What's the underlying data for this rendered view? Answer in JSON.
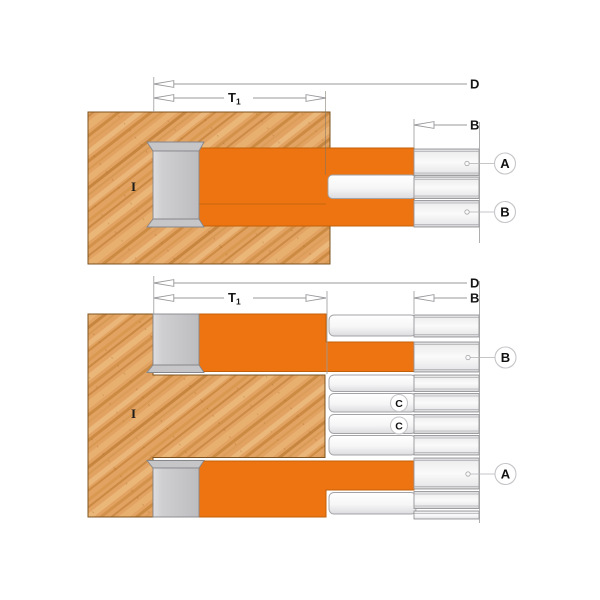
{
  "page": {
    "background": "#ffffff"
  },
  "figure": {
    "type": "technical-diagram",
    "subject": "adjustable-groover-cutter-head-cross-section",
    "colors": {
      "cutter_orange": "#ED7410",
      "cutter_orange_edge": "#C05F08",
      "wood_tan": "#E2A261",
      "wood_grain_dark": "#B9772A",
      "steel_gray": "#C6C6C9",
      "plate_edge_gray": "#96969A",
      "dim_line_gray": "#9A9A9A",
      "label_black": "#151515"
    },
    "labels": {
      "overall_diameter": "D",
      "cutting_depth": "T",
      "cutting_depth_sub": "1",
      "kerf_width": "B",
      "bore": "I"
    },
    "views": {
      "top": {
        "name": "assembled-minimum-width",
        "callouts": [
          "A",
          "B"
        ]
      },
      "bottom": {
        "name": "extended-maximum-width-with-shims",
        "callouts": [
          "B",
          "A"
        ],
        "shim_callouts": [
          "C",
          "C"
        ]
      }
    }
  }
}
